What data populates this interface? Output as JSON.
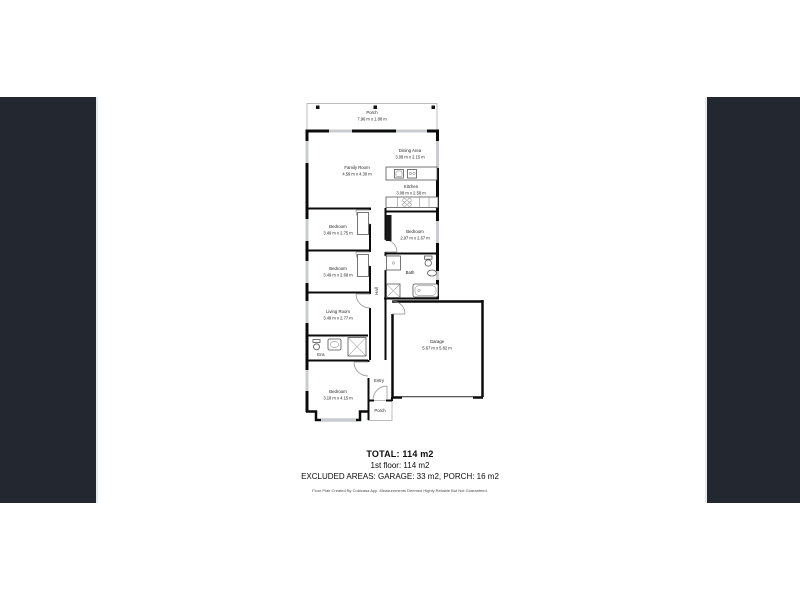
{
  "canvas": {
    "background": "#ffffff",
    "side_panel_color": "#232830",
    "wall_color": "#0b0b0b",
    "window_color": "#c9cdd1"
  },
  "floorplan": {
    "rooms": {
      "porch_top": {
        "name": "Porch",
        "dims": "7.96 m x 1.88 m"
      },
      "family_room": {
        "name": "Family Room",
        "dims": "4.59 m x 4.30 m"
      },
      "dining_area": {
        "name": "Dining Area",
        "dims": "3.08 m x 2.15 m"
      },
      "kitchen": {
        "name": "Kitchen",
        "dims": "3.08 m x 2.58 m"
      },
      "bedroom_1": {
        "name": "Bedroom",
        "dims": "3.49 m x 2.75 m"
      },
      "bedroom_2": {
        "name": "Bedroom",
        "dims": "2.97 m x 2.67 m"
      },
      "bedroom_3": {
        "name": "Bedroom",
        "dims": "3.49 m x 2.68 m"
      },
      "bath": {
        "name": "Bath"
      },
      "hall": {
        "name": "Hall"
      },
      "living_room": {
        "name": "Living Room",
        "dims": "3.49 m x 2.77 m"
      },
      "ensuite": {
        "name": "Ens"
      },
      "garage": {
        "name": "Garage",
        "dims": "5.67 m x 5.82 m"
      },
      "entry": {
        "name": "Entry"
      },
      "bedroom_4": {
        "name": "Bedroom",
        "dims": "3.18 m x 4.15 m"
      },
      "porch_bottom": {
        "name": "Porch"
      }
    }
  },
  "summary": {
    "total": "TOTAL: 114 m2",
    "first_floor": "1st floor: 114 m2",
    "excluded": "EXCLUDED AREAS: GARAGE: 33 m2, PORCH: 16 m2",
    "disclaimer": "Floor Plan Created By Cubicasa App. Measurements Deemed Highly Reliable But Not Guaranteed."
  }
}
